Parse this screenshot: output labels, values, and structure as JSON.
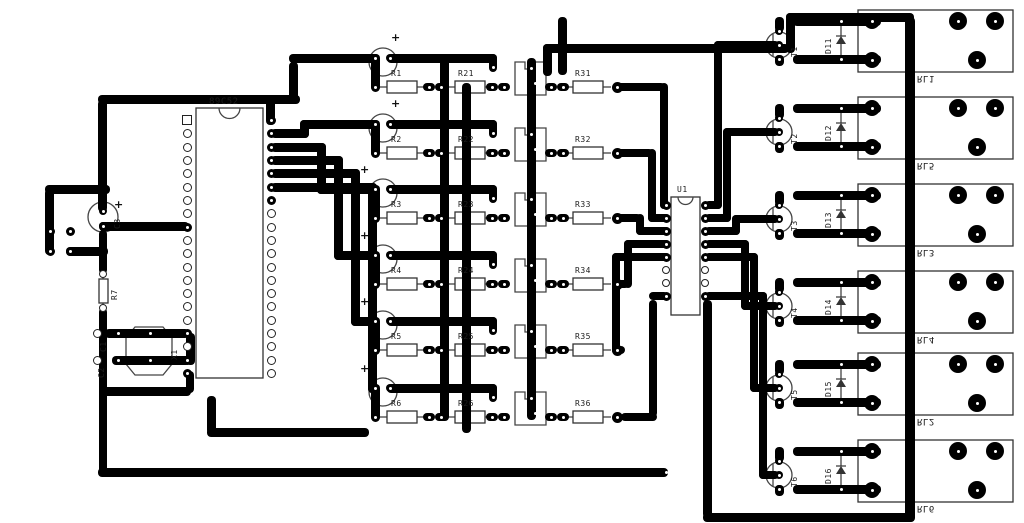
{
  "board": {
    "mcu_label": "89C52",
    "u1_label": "U1",
    "r7_label": "R7",
    "crystal_label": "X1",
    "cap_c1_label": "C1",
    "cap_c2_label": "C2",
    "cap_c3_label": "C3",
    "plus_sign": "+",
    "channel_resistors": [
      "R1",
      "R2",
      "R3",
      "R4",
      "R5",
      "R6"
    ],
    "mid_resistors": [
      "R21",
      "R22",
      "R23",
      "R24",
      "R25",
      "R26"
    ],
    "output_resistors": [
      "R31",
      "R32",
      "R33",
      "R34",
      "R35",
      "R36"
    ],
    "transistors": [
      "T1",
      "T2",
      "T3",
      "T4",
      "T5",
      "T6"
    ],
    "diodes": [
      "D11",
      "D12",
      "D13",
      "D14",
      "D15",
      "D16"
    ],
    "relays": [
      "RL1",
      "RL5",
      "RL3",
      "RL4",
      "RL2",
      "RL6"
    ],
    "colors": {
      "trace": "#000000",
      "silkscreen": "#333333",
      "background": "#ffffff"
    }
  }
}
